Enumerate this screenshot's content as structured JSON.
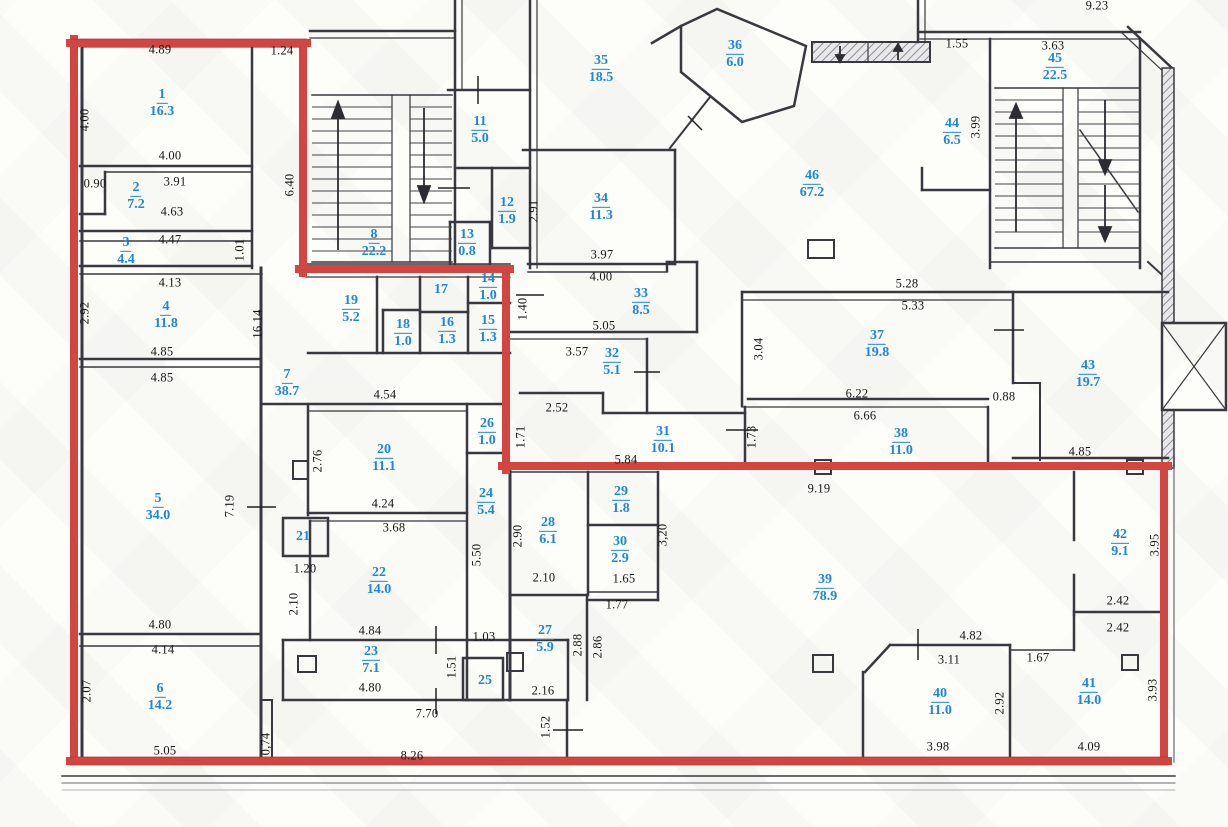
{
  "plan": {
    "kind": "architectural floor plan",
    "units": "m / m2",
    "colors": {
      "boundary_red": "#d34540",
      "room_label_blue": "#1e87db",
      "wall_dark": "#383840",
      "dimension_text": "#161616"
    },
    "rooms": [
      {
        "n": "1",
        "a": "16.3",
        "x": 162,
        "y": 103
      },
      {
        "n": "2",
        "a": "7.2",
        "x": 136,
        "y": 196
      },
      {
        "n": "3",
        "a": "4.4",
        "x": 126,
        "y": 251
      },
      {
        "n": "4",
        "a": "11.8",
        "x": 166,
        "y": 315
      },
      {
        "n": "5",
        "a": "34.0",
        "x": 158,
        "y": 507
      },
      {
        "n": "6",
        "a": "14.2",
        "x": 160,
        "y": 697
      },
      {
        "n": "7",
        "a": "38.7",
        "x": 287,
        "y": 383
      },
      {
        "n": "8",
        "a": "22.2",
        "x": 374,
        "y": 243
      },
      {
        "n": "11",
        "a": "5.0",
        "x": 480,
        "y": 130
      },
      {
        "n": "12",
        "a": "1.9",
        "x": 507,
        "y": 211
      },
      {
        "n": "13",
        "a": "0.8",
        "x": 467,
        "y": 243
      },
      {
        "n": "14",
        "a": "1.0",
        "x": 488,
        "y": 287
      },
      {
        "n": "15",
        "a": "1.3",
        "x": 488,
        "y": 329
      },
      {
        "n": "16",
        "a": "1.3",
        "x": 447,
        "y": 331
      },
      {
        "n": "17",
        "a": "",
        "x": 441,
        "y": 290
      },
      {
        "n": "18",
        "a": "1.0",
        "x": 403,
        "y": 333
      },
      {
        "n": "19",
        "a": "5.2",
        "x": 351,
        "y": 309
      },
      {
        "n": "20",
        "a": "11.1",
        "x": 384,
        "y": 458
      },
      {
        "n": "21",
        "a": "",
        "x": 303,
        "y": 537
      },
      {
        "n": "22",
        "a": "14.0",
        "x": 379,
        "y": 581
      },
      {
        "n": "23",
        "a": "7.1",
        "x": 371,
        "y": 660
      },
      {
        "n": "24",
        "a": "5.4",
        "x": 486,
        "y": 502
      },
      {
        "n": "25",
        "a": "",
        "x": 485,
        "y": 681
      },
      {
        "n": "26",
        "a": "1.0",
        "x": 487,
        "y": 432
      },
      {
        "n": "27",
        "a": "5.9",
        "x": 545,
        "y": 639
      },
      {
        "n": "28",
        "a": "6.1",
        "x": 548,
        "y": 531
      },
      {
        "n": "29",
        "a": "1.8",
        "x": 621,
        "y": 500
      },
      {
        "n": "30",
        "a": "2.9",
        "x": 620,
        "y": 550
      },
      {
        "n": "31",
        "a": "10.1",
        "x": 663,
        "y": 440
      },
      {
        "n": "32",
        "a": "5.1",
        "x": 612,
        "y": 362
      },
      {
        "n": "33",
        "a": "8.5",
        "x": 641,
        "y": 302
      },
      {
        "n": "34",
        "a": "11.3",
        "x": 601,
        "y": 207
      },
      {
        "n": "35",
        "a": "18.5",
        "x": 601,
        "y": 69
      },
      {
        "n": "36",
        "a": "6.0",
        "x": 735,
        "y": 54
      },
      {
        "n": "37",
        "a": "19.8",
        "x": 877,
        "y": 344
      },
      {
        "n": "38",
        "a": "11.0",
        "x": 901,
        "y": 442
      },
      {
        "n": "39",
        "a": "78.9",
        "x": 825,
        "y": 588
      },
      {
        "n": "40",
        "a": "11.0",
        "x": 940,
        "y": 702
      },
      {
        "n": "41",
        "a": "14.0",
        "x": 1089,
        "y": 692
      },
      {
        "n": "42",
        "a": "9.1",
        "x": 1120,
        "y": 543
      },
      {
        "n": "43",
        "a": "19.7",
        "x": 1088,
        "y": 374
      },
      {
        "n": "44",
        "a": "6.5",
        "x": 952,
        "y": 132
      },
      {
        "n": "45",
        "a": "22.5",
        "x": 1055,
        "y": 67
      },
      {
        "n": "46",
        "a": "67.2",
        "x": 812,
        "y": 184
      }
    ],
    "dimensions": [
      {
        "t": "4.89",
        "x": 160,
        "y": 50,
        "v": false
      },
      {
        "t": "1.24",
        "x": 282,
        "y": 51,
        "v": false
      },
      {
        "t": "4.00",
        "x": 85,
        "y": 120,
        "v": true
      },
      {
        "t": "0.90",
        "x": 95,
        "y": 184,
        "v": false
      },
      {
        "t": "4.00",
        "x": 170,
        "y": 156,
        "v": false
      },
      {
        "t": "3.91",
        "x": 175,
        "y": 182,
        "v": false
      },
      {
        "t": "4.63",
        "x": 172,
        "y": 212,
        "v": false
      },
      {
        "t": "4.47",
        "x": 170,
        "y": 240,
        "v": false
      },
      {
        "t": "1.01",
        "x": 240,
        "y": 250,
        "v": true
      },
      {
        "t": "6.40",
        "x": 290,
        "y": 185,
        "v": true
      },
      {
        "t": "2.92",
        "x": 85,
        "y": 313,
        "v": true
      },
      {
        "t": "4.13",
        "x": 170,
        "y": 283,
        "v": false
      },
      {
        "t": "16.14",
        "x": 258,
        "y": 324,
        "v": true
      },
      {
        "t": "4.85",
        "x": 162,
        "y": 352,
        "v": false
      },
      {
        "t": "4.85",
        "x": 162,
        "y": 378,
        "v": false
      },
      {
        "t": "7.19",
        "x": 230,
        "y": 506,
        "v": true
      },
      {
        "t": "4.80",
        "x": 160,
        "y": 625,
        "v": false
      },
      {
        "t": "4.14",
        "x": 163,
        "y": 650,
        "v": false
      },
      {
        "t": "2.07",
        "x": 87,
        "y": 691,
        "v": true
      },
      {
        "t": "5.05",
        "x": 165,
        "y": 751,
        "v": false
      },
      {
        "t": "0,74",
        "x": 266,
        "y": 744,
        "v": true
      },
      {
        "t": "8.26",
        "x": 412,
        "y": 756,
        "v": false
      },
      {
        "t": "7.70",
        "x": 427,
        "y": 714,
        "v": false
      },
      {
        "t": "4.84",
        "x": 370,
        "y": 631,
        "v": false
      },
      {
        "t": "4.80",
        "x": 370,
        "y": 688,
        "v": false
      },
      {
        "t": "1.51",
        "x": 452,
        "y": 667,
        "v": true
      },
      {
        "t": "1.03",
        "x": 484,
        "y": 637,
        "v": false
      },
      {
        "t": "2.16",
        "x": 543,
        "y": 691,
        "v": false
      },
      {
        "t": "1.52",
        "x": 546,
        "y": 727,
        "v": true
      },
      {
        "t": "2.88",
        "x": 578,
        "y": 645,
        "v": true
      },
      {
        "t": "2.86",
        "x": 598,
        "y": 647,
        "v": true
      },
      {
        "t": "2.10",
        "x": 294,
        "y": 604,
        "v": true
      },
      {
        "t": "1.20",
        "x": 305,
        "y": 569,
        "v": false
      },
      {
        "t": "3.68",
        "x": 394,
        "y": 528,
        "v": false
      },
      {
        "t": "4.24",
        "x": 383,
        "y": 504,
        "v": false
      },
      {
        "t": "2.76",
        "x": 318,
        "y": 461,
        "v": true
      },
      {
        "t": "4.54",
        "x": 385,
        "y": 395,
        "v": false
      },
      {
        "t": "5.50",
        "x": 477,
        "y": 555,
        "v": true
      },
      {
        "t": "2.90",
        "x": 518,
        "y": 536,
        "v": true
      },
      {
        "t": "2.10",
        "x": 544,
        "y": 578,
        "v": false
      },
      {
        "t": "1.65",
        "x": 624,
        "y": 579,
        "v": false
      },
      {
        "t": "1.77",
        "x": 617,
        "y": 605,
        "v": false
      },
      {
        "t": "3,20",
        "x": 663,
        "y": 535,
        "v": true
      },
      {
        "t": "9.19",
        "x": 819,
        "y": 489,
        "v": false
      },
      {
        "t": "4.82",
        "x": 971,
        "y": 636,
        "v": false
      },
      {
        "t": "3.11",
        "x": 949,
        "y": 660,
        "v": false
      },
      {
        "t": "1.67",
        "x": 1038,
        "y": 658,
        "v": false
      },
      {
        "t": "2.92",
        "x": 1000,
        "y": 703,
        "v": true
      },
      {
        "t": "3.98",
        "x": 938,
        "y": 747,
        "v": false
      },
      {
        "t": "4.09",
        "x": 1089,
        "y": 747,
        "v": false
      },
      {
        "t": "2.42",
        "x": 1118,
        "y": 601,
        "v": false
      },
      {
        "t": "2.42",
        "x": 1118,
        "y": 628,
        "v": false
      },
      {
        "t": "3.93",
        "x": 1153,
        "y": 690,
        "v": true
      },
      {
        "t": "3.95",
        "x": 1155,
        "y": 545,
        "v": true
      },
      {
        "t": "4.85",
        "x": 1080,
        "y": 452,
        "v": false
      },
      {
        "t": "0.88",
        "x": 1004,
        "y": 397,
        "v": false
      },
      {
        "t": "6.22",
        "x": 857,
        "y": 394,
        "v": false
      },
      {
        "t": "6.66",
        "x": 865,
        "y": 416,
        "v": false
      },
      {
        "t": "1.73",
        "x": 752,
        "y": 437,
        "v": true
      },
      {
        "t": "5.84",
        "x": 626,
        "y": 460,
        "v": false
      },
      {
        "t": "1.71",
        "x": 521,
        "y": 437,
        "v": true
      },
      {
        "t": "2.52",
        "x": 557,
        "y": 408,
        "v": false
      },
      {
        "t": "3.57",
        "x": 577,
        "y": 352,
        "v": false
      },
      {
        "t": "5.05",
        "x": 604,
        "y": 326,
        "v": false
      },
      {
        "t": "3.04",
        "x": 759,
        "y": 349,
        "v": true
      },
      {
        "t": "5.28",
        "x": 907,
        "y": 284,
        "v": false
      },
      {
        "t": "5.33",
        "x": 913,
        "y": 306,
        "v": false
      },
      {
        "t": "1.40",
        "x": 523,
        "y": 309,
        "v": true
      },
      {
        "t": "4.00",
        "x": 601,
        "y": 277,
        "v": false
      },
      {
        "t": "3.97",
        "x": 602,
        "y": 255,
        "v": false
      },
      {
        "t": "2.91",
        "x": 534,
        "y": 211,
        "v": true
      },
      {
        "t": "9.23",
        "x": 1097,
        "y": 6,
        "v": false
      },
      {
        "t": "1.55",
        "x": 957,
        "y": 44,
        "v": false
      },
      {
        "t": "3.63",
        "x": 1053,
        "y": 46,
        "v": false
      },
      {
        "t": "3.99",
        "x": 976,
        "y": 127,
        "v": true
      }
    ]
  }
}
